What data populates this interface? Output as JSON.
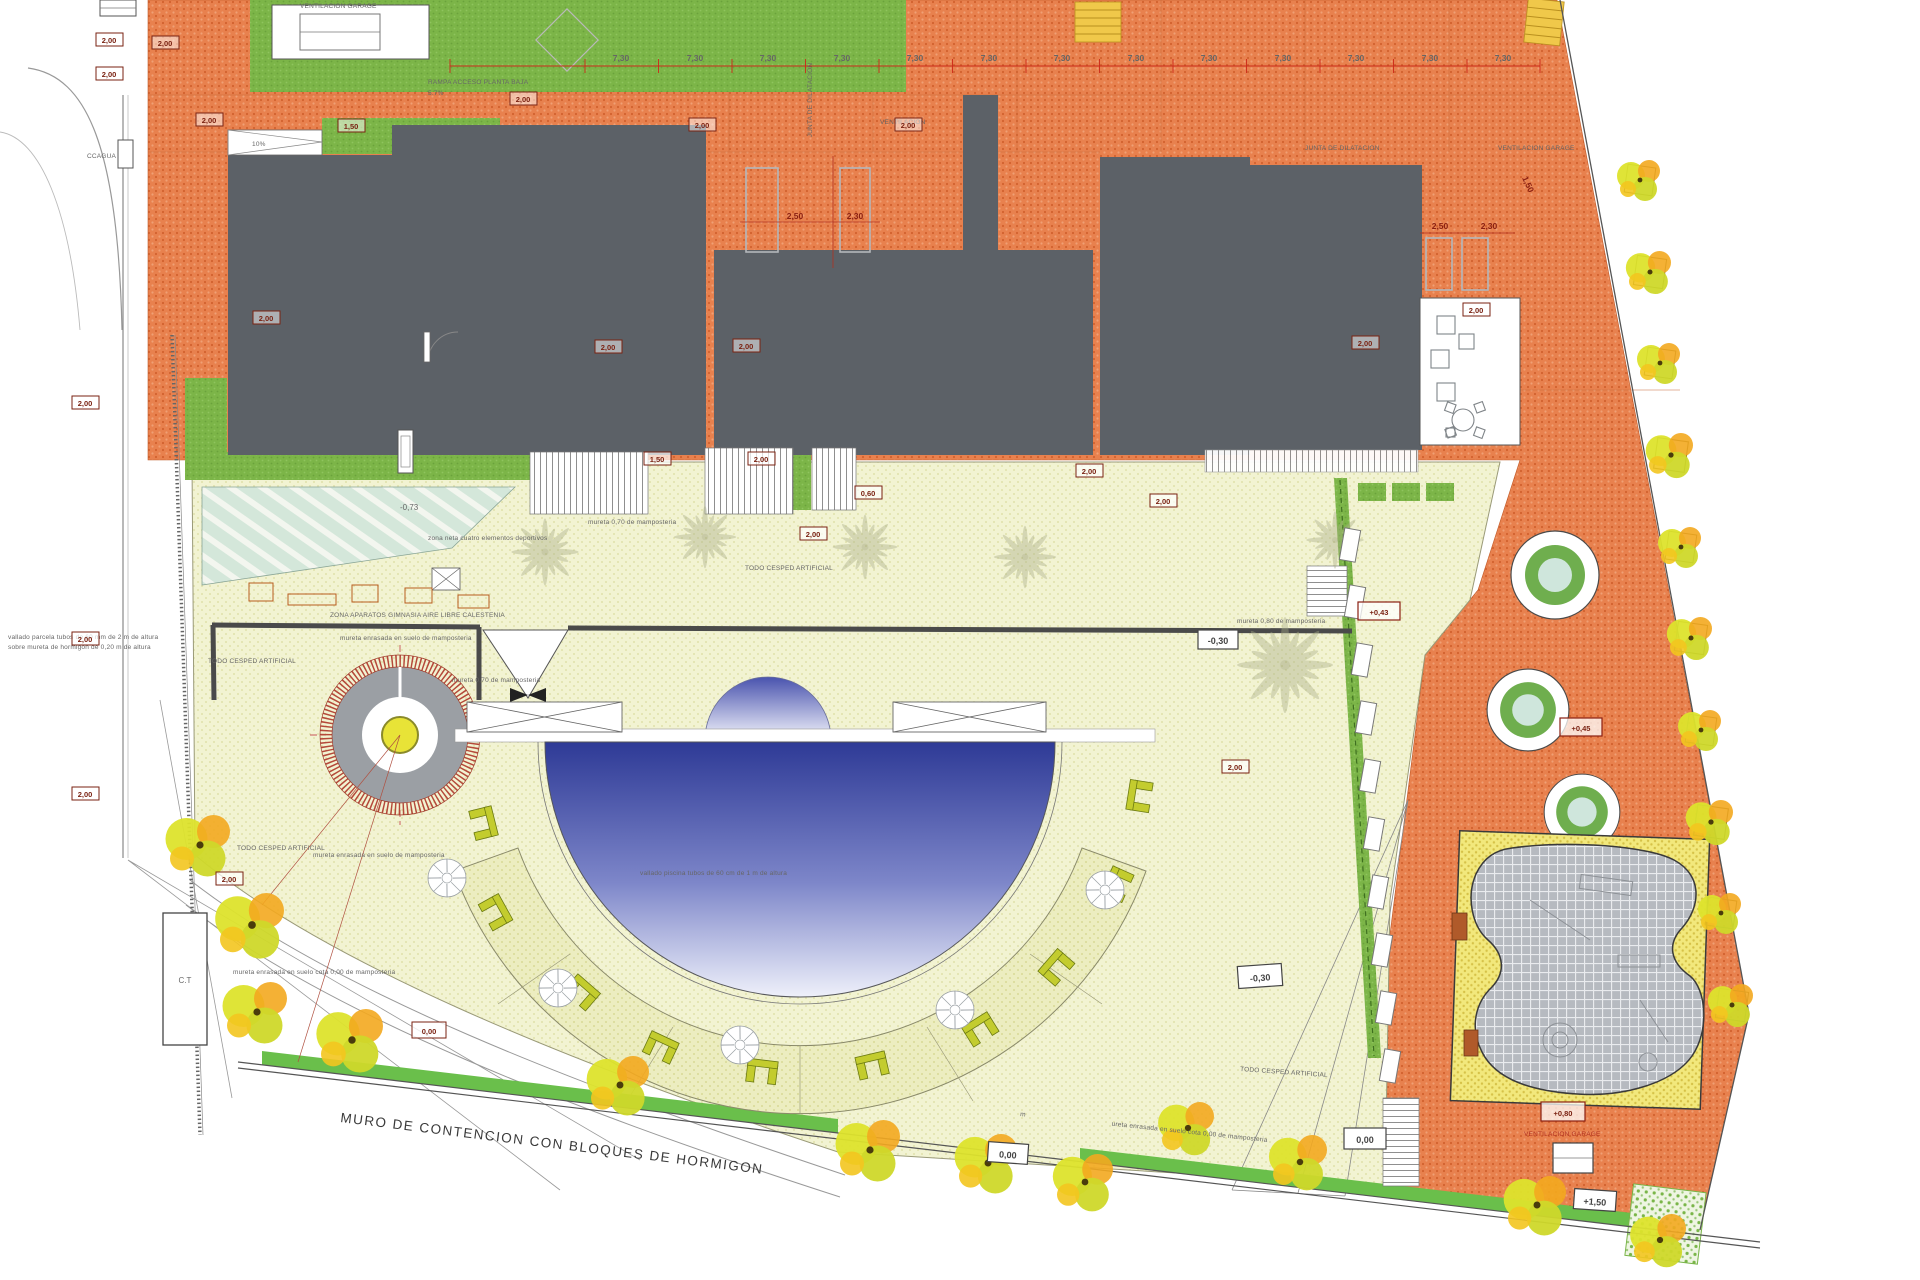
{
  "labels": {
    "ventilacion_garage": "VENTILACION GARAGE",
    "ventilacion": "VENTILACION",
    "junta_dilatacion": "JUNTA DE DILATACION",
    "rampa": "RAMPA ACCESO PLANTA BAJA",
    "rampa_slope": "5.7%",
    "slope10": "10%",
    "ccagua": "CCAGUA",
    "ct": "C.T",
    "todo_cesped": "TODO CESPED ARTIFICIAL",
    "zona_aparatos": "ZONA APARATOS GIMNASIA AIRE LIBRE CALESTENIA",
    "zona_neta": "zona neta cuatro elementos deportivos",
    "mureta_enrasada": "mureta enrasada en suelo de mamposteria",
    "mureta_enrasada_cota": "mureta enrasada en suelo cota 0,00 de mamposteria",
    "mureta_070": "mureta 0,70 de mamposteria",
    "mureta_080": "mureta 0,80 de mamposteria",
    "vallado_parcela_l1": "vallado parcela tubos de 60 mm de 2 m de altura",
    "vallado_parcela_l2": "sobre mureta de hormigon de 0,20 m de altura",
    "vallado_piscina": "vallado piscina tubos de 60 cm de 1 m de altura",
    "muro_contencion": "MURO DE CONTENCION  CON BLOQUES DE HORMIGON"
  },
  "levels": {
    "m073": "-0,73",
    "m030": "-0,30",
    "p043": "+0,43",
    "p045": "+0,45",
    "p080": "+0,80",
    "p150": "+1,50",
    "zero": "0,00"
  },
  "dims": {
    "d730": "7,30",
    "d250": "2,50",
    "d230": "2,30",
    "d200": "2,00",
    "d150": "1,50",
    "d060": "0,60"
  },
  "colors": {
    "paving": "#e8814e",
    "grass": "#7cb548",
    "roof": "#5c6167",
    "terrace": "#f2f3d2",
    "pool_deep": "#2e3a96",
    "play_sand": "#f2e87c",
    "dim_red": "#b03020"
  }
}
